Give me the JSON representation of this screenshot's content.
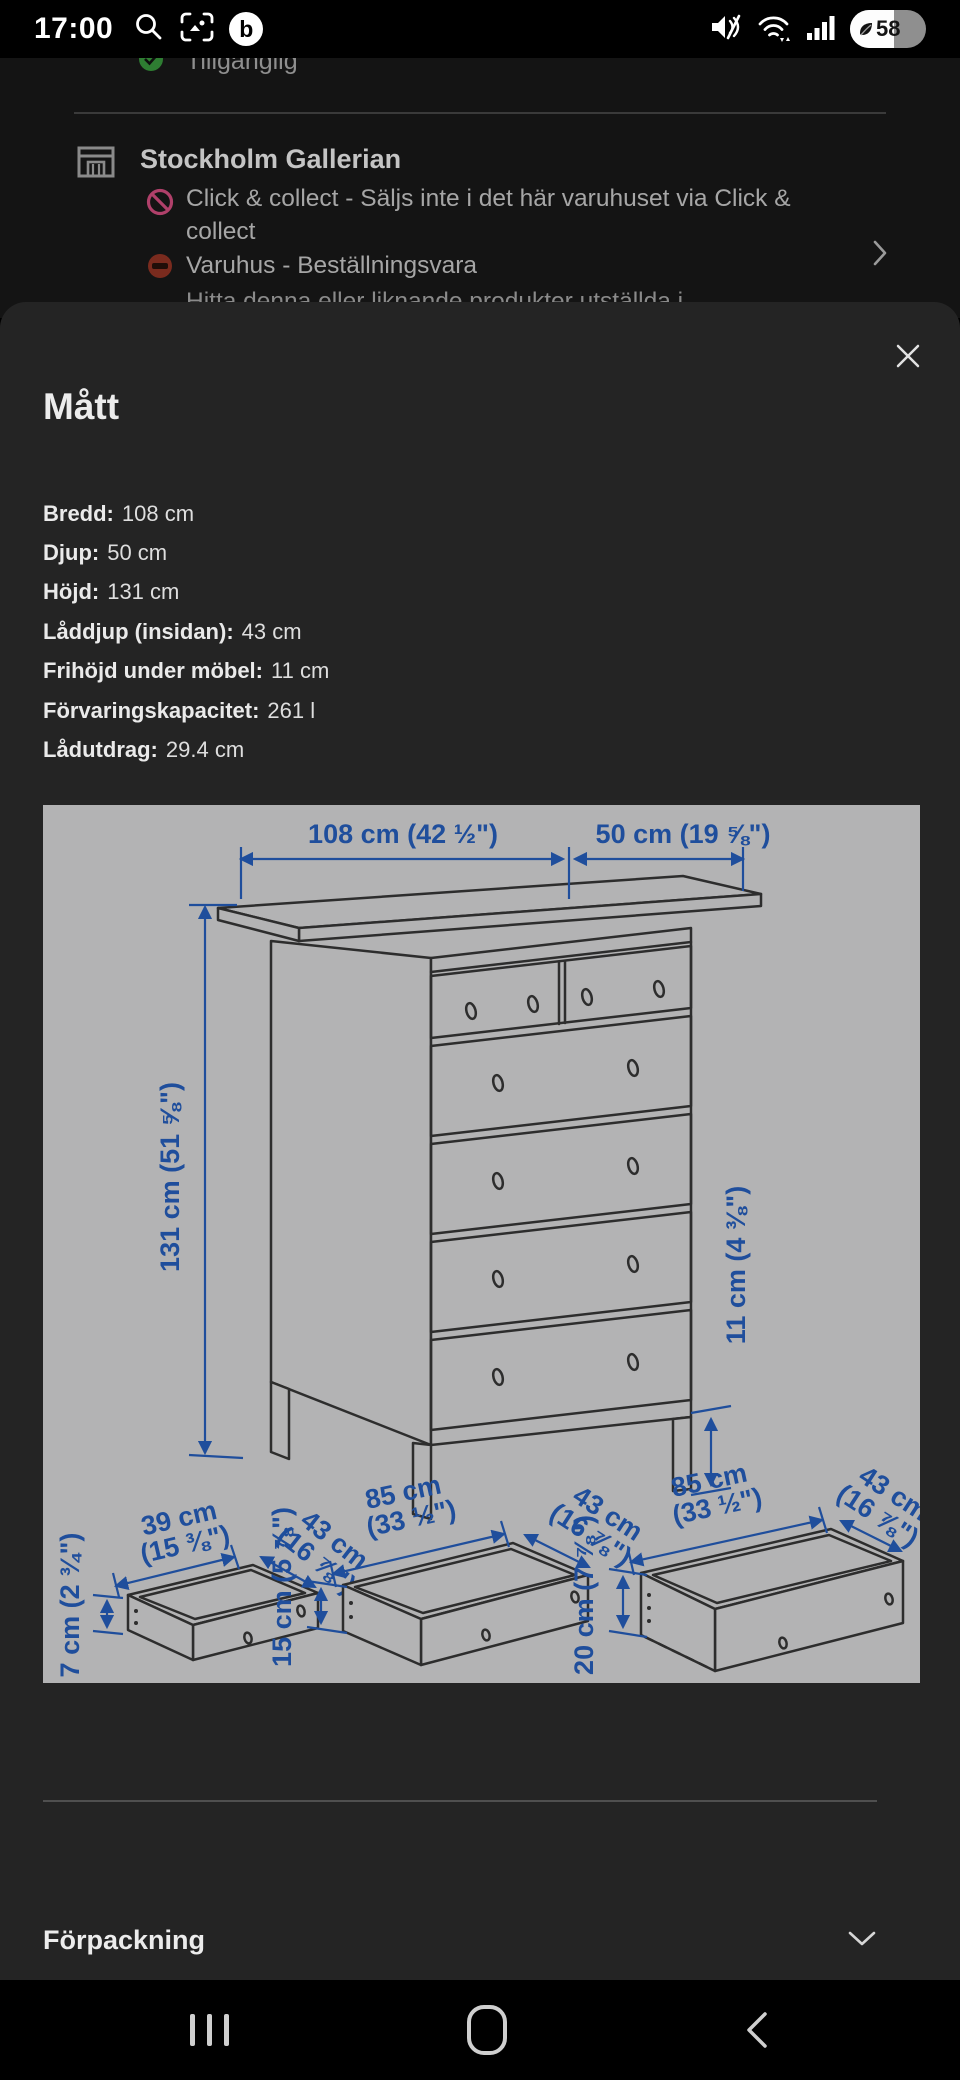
{
  "status_bar": {
    "time": "17:00",
    "battery_percent": "58"
  },
  "background_page": {
    "availability_status": "Tillgänglig",
    "store_row": {
      "name": "Stockholm Gallerian",
      "click_collect_note": "Click & collect - Säljs inte i det här varuhuset via Click & collect",
      "warehouse_note": "Varuhus - Beställningsvara"
    },
    "clipped_text": "Hitta denna eller liknande produkter utställda i"
  },
  "modal": {
    "title": "Mått",
    "measurements": [
      {
        "label": "Bredd:",
        "value": "108 cm"
      },
      {
        "label": "Djup:",
        "value": "50 cm"
      },
      {
        "label": "Höjd:",
        "value": "131 cm"
      },
      {
        "label": "Låddjup (insidan):",
        "value": "43 cm"
      },
      {
        "label": "Frihöjd under möbel:",
        "value": "11 cm"
      },
      {
        "label": "Förvaringskapacitet:",
        "value": "261 l"
      },
      {
        "label": "Lådutdrag:",
        "value": "29.4 cm"
      }
    ],
    "diagram": {
      "width_top": "108 cm (42 ½\")",
      "depth_top": "50 cm (19 ⅝\")",
      "height_left": "131 cm (51 ⅝\")",
      "clearance_right": "11 cm (4 ⅜\")",
      "drawers": [
        {
          "width_line1": "39 cm",
          "width_line2": "(15 ⅜\")",
          "depth_line1": "43 cm",
          "depth_line2": "(16 ⅞\")",
          "height": "7 cm (2 ¾\")"
        },
        {
          "width_line1": "85 cm",
          "width_line2": "(33 ½\")",
          "depth_line1": "43 cm",
          "depth_line2": "(16 ⅞\")",
          "height": "15 cm (5 ⅞\")"
        },
        {
          "width_line1": "85 cm",
          "width_line2": "(33 ½\")",
          "depth_line1": "43 cm",
          "depth_line2": "(16 ⅞\")",
          "height": "20 cm (7 ⅞\")"
        }
      ]
    },
    "sections": [
      {
        "label": "Förpackning"
      }
    ]
  },
  "colors": {
    "modal_bg": "#242424",
    "page_bg": "#141414",
    "diagram_bg": "#b3b3b4",
    "dimension_blue": "#1f4e9c",
    "success_green": "#2e7d32",
    "restriction_pink": "#b0406a",
    "warning_red": "#7a2b1e"
  }
}
